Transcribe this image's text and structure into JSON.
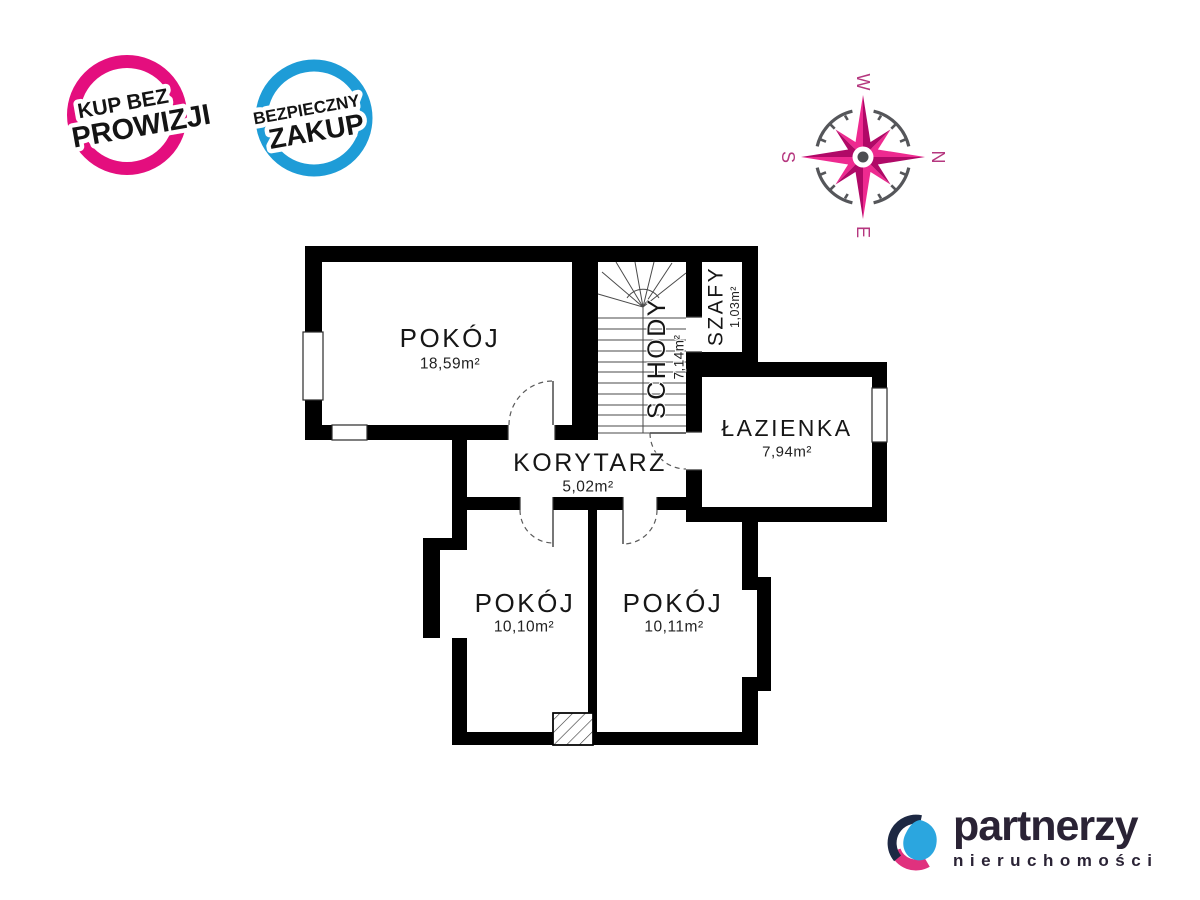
{
  "badges": {
    "no_commission": {
      "line1": "KUP BEZ",
      "line2": "PROWIZJI",
      "ring_color": "#E40E7E"
    },
    "safe_purchase": {
      "line1": "BEZPIECZNY",
      "line2": "ZAKUP",
      "ring_color": "#1E9CD7"
    }
  },
  "compass": {
    "top": "W",
    "right": "N",
    "bottom": "E",
    "left": "S",
    "star_light": "#EE2A90",
    "star_dark": "#B00967",
    "ring_color": "#55565A",
    "letter_color": "#B5377F"
  },
  "floorplan": {
    "wall_color": "#000000",
    "rooms": [
      {
        "name": "POKÓJ",
        "area": "18,59m²"
      },
      {
        "name": "SCHODY",
        "area": "7,14m²"
      },
      {
        "name": "SZAFY",
        "area": "1,03m²"
      },
      {
        "name": "ŁAZIENKA",
        "area": "7,94m²"
      },
      {
        "name": "KORYTARZ",
        "area": "5,02m²"
      },
      {
        "name": "POKÓJ",
        "area": "10,10m²"
      },
      {
        "name": "POKÓJ",
        "area": "10,11m²"
      }
    ]
  },
  "logo": {
    "brand": "partnerzy",
    "subtitle": "nieruchomości",
    "text_color": "#2A2335",
    "blue": "#2BA6DF",
    "pink": "#E0317E",
    "navy": "#1D2843"
  }
}
